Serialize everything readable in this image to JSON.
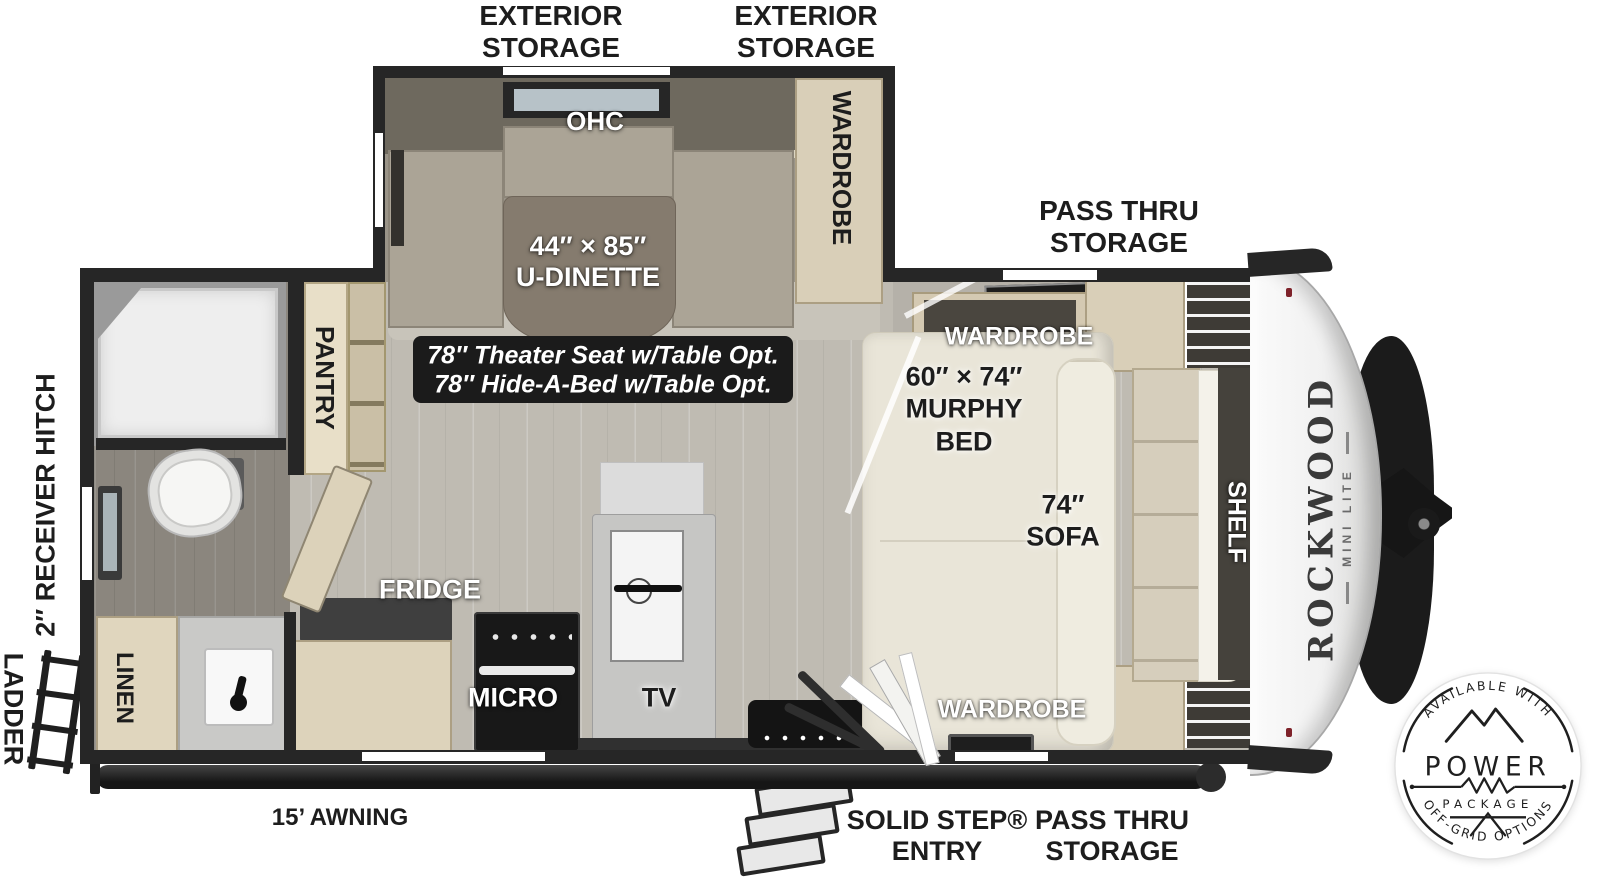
{
  "brand": {
    "name": "ROCKWOOD",
    "series": "MINI LITE"
  },
  "exterior": {
    "storage": [
      "EXTERIOR",
      "STORAGE"
    ],
    "pass_thru": [
      "PASS THRU",
      "STORAGE"
    ],
    "entry": [
      "SOLID STEP®",
      "ENTRY"
    ],
    "awning": "15’ AWNING",
    "hitch": "2″ RECEIVER HITCH",
    "ladder": "LADDER"
  },
  "interior": {
    "ohc": "OHC",
    "dinette_size": "44″ × 85″",
    "dinette": "U-DINETTE",
    "options": [
      "78″ Theater Seat w/Table Opt.",
      "78″ Hide-A-Bed w/Table Opt."
    ],
    "wardrobe": "WARDROBE",
    "pantry": "PANTRY",
    "murphy": [
      "60″ × 74″",
      "MURPHY",
      "BED"
    ],
    "sofa": [
      "74″",
      "SOFA"
    ],
    "shelf": "SHELF",
    "fridge": "FRIDGE",
    "micro": "MICRO",
    "tv": "TV",
    "linen": "LINEN"
  },
  "badge": {
    "top": "AVAILABLE WITH",
    "word": "POWER",
    "package": "PACKAGE",
    "bottom": "OFF-GRID OPTIONS"
  }
}
